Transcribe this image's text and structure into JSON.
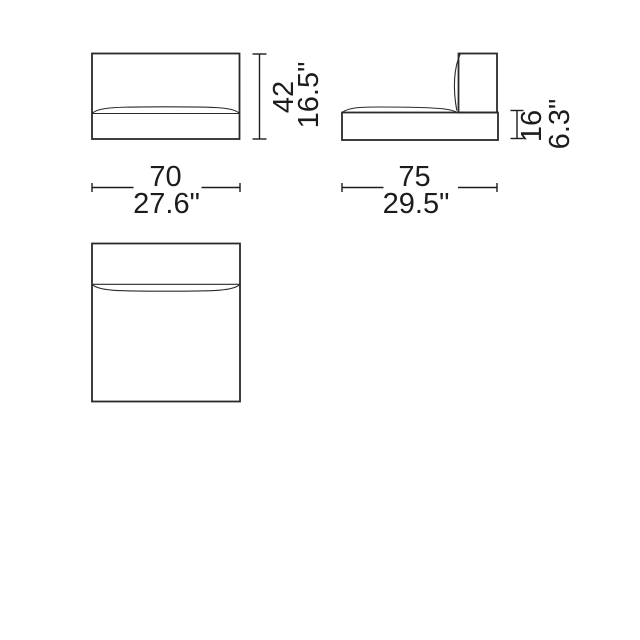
{
  "drawing": {
    "type": "furniture-module-orthographic-views",
    "colors": {
      "line": "#2a2a2a",
      "text": "#1c1c1c",
      "background": "#ffffff"
    },
    "views": {
      "front": {
        "height": {
          "cm": "42",
          "inches": "16.5\""
        },
        "width": {
          "cm": "70",
          "inches": "27.6\""
        }
      },
      "side": {
        "base_height": {
          "cm": "16",
          "inches": "6.3\""
        },
        "width": {
          "cm": "75",
          "inches": "29.5\""
        }
      },
      "top": {}
    }
  }
}
